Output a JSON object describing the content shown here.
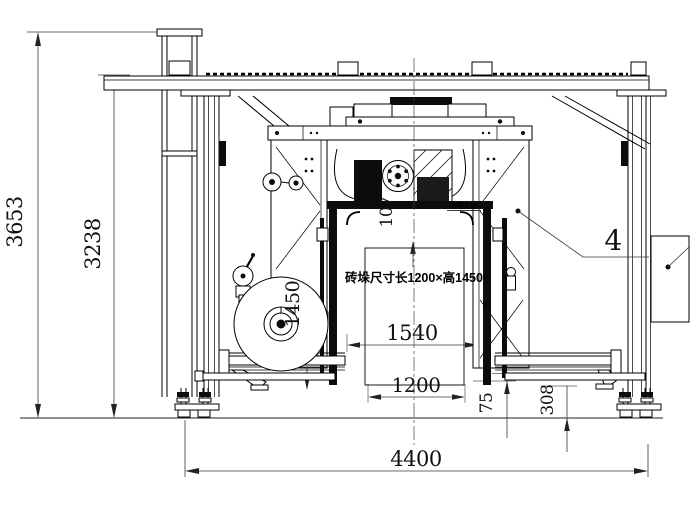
{
  "dims": {
    "overall_height": "3653",
    "beam_height": "3238",
    "overall_width": "4400",
    "gate_opening_width": "1540",
    "stack_width": "1200",
    "stack_side_height": "1450",
    "head_clearance": "107",
    "platform_offset": "75",
    "platform_height": "308"
  },
  "annotations": {
    "stack_size_note": "砖垛尺寸长1200×高1450",
    "part_callout": "4",
    "direction_note": "穿带方向"
  },
  "colors": {
    "line": "#000000",
    "dimension": "#3a3a3a",
    "background": "#ffffff"
  }
}
